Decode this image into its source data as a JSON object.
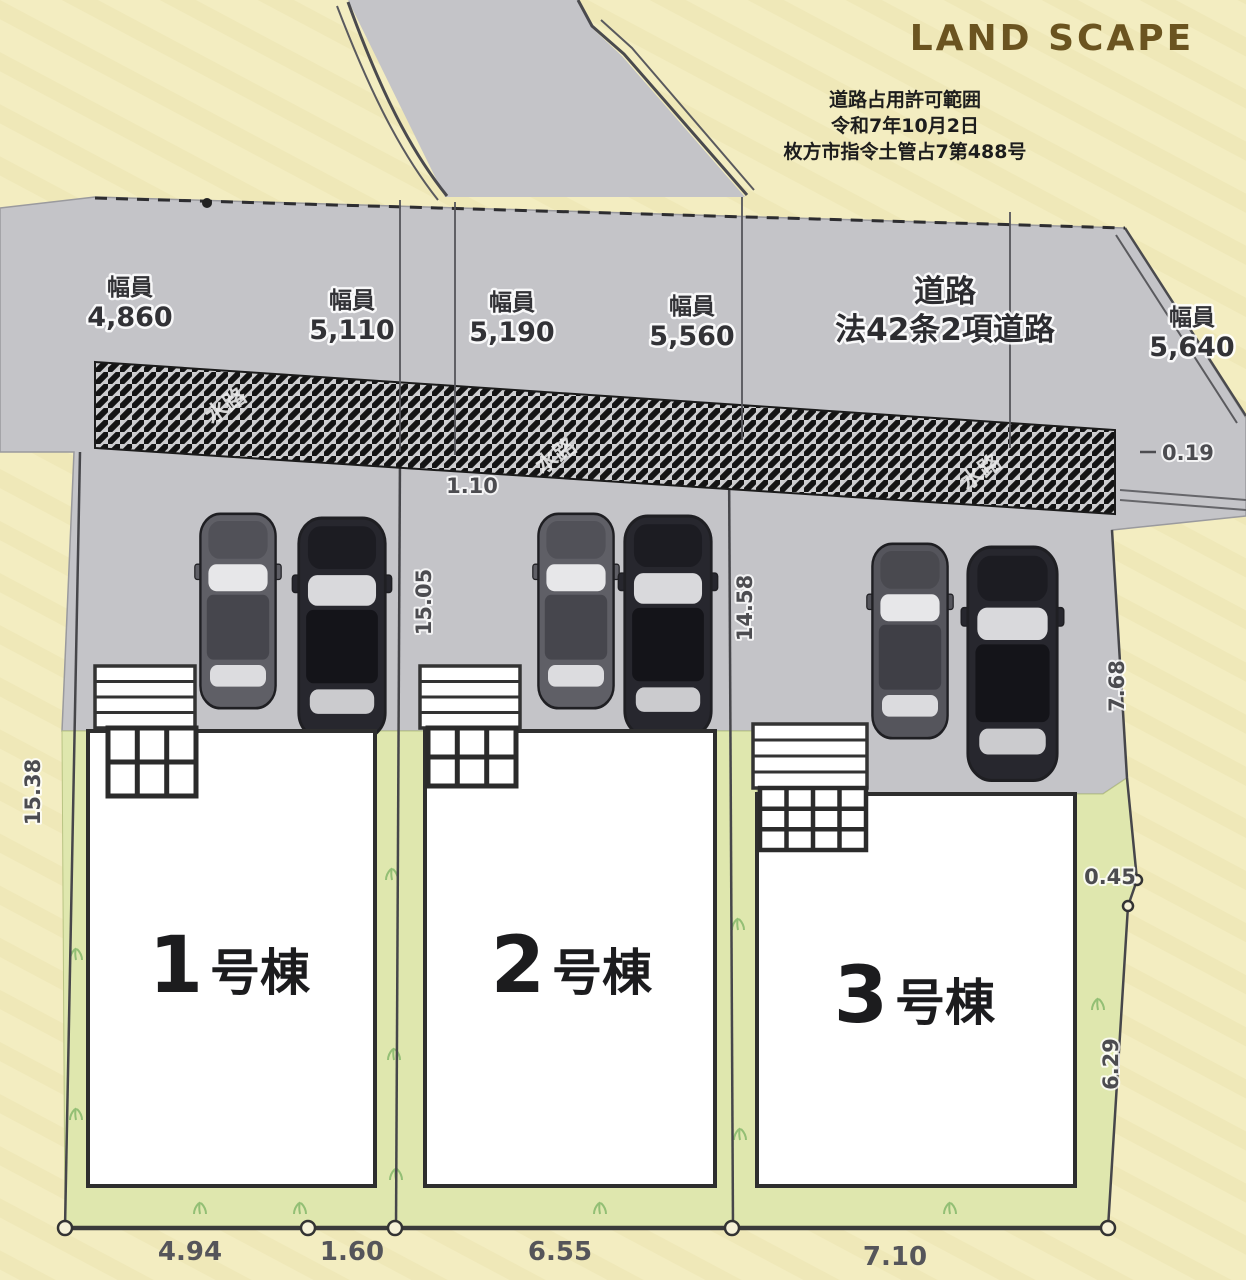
{
  "header": {
    "title": "LAND SCAPE"
  },
  "permit": {
    "line1": "道路占用許可範囲",
    "line2": "令和7年10月2日",
    "line3": "枚方市指令土管占7第488号"
  },
  "road": {
    "name": "道路",
    "type": "法42条2項道路",
    "width_label": "幅員",
    "widths": [
      "4,860",
      "5,110",
      "5,190",
      "5,560",
      "5,640"
    ],
    "waterway": "水路"
  },
  "buildings": [
    {
      "number": "1",
      "suffix": "号棟"
    },
    {
      "number": "2",
      "suffix": "号棟"
    },
    {
      "number": "3",
      "suffix": "号棟"
    }
  ],
  "dimensions": {
    "left_depth": "15.38",
    "plot1_offset": "1.10",
    "plot1_depth": "15.05",
    "plot2_depth": "14.58",
    "right_upper": "7.68",
    "right_jog": "0.45",
    "right_lower": "6.29",
    "waterway_right": "0.19",
    "bottom": [
      "4.94",
      "1.60",
      "6.55",
      "7.10"
    ]
  },
  "colors": {
    "background": "#f3edc1",
    "road_gray": "#c4c4c8",
    "plot_green": "#dfe7ae",
    "building": "#ffffff",
    "brand_brown": "#6b5420"
  }
}
